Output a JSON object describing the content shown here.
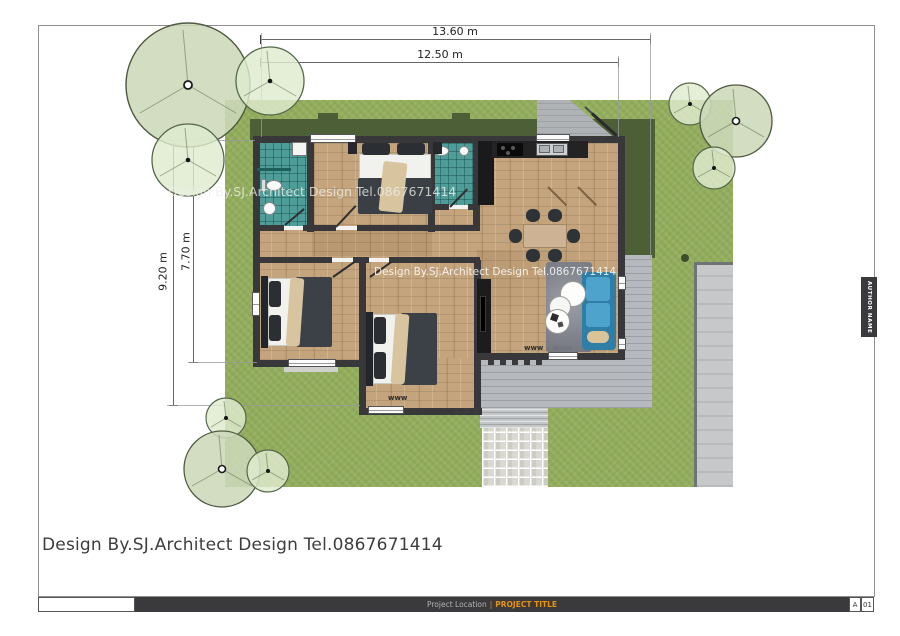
{
  "drawing": {
    "dimensions": {
      "top_outer": "13.60 m",
      "top_inner": "12.50 m",
      "left_outer": "9.20 m",
      "left_inner": "7.70 m"
    },
    "watermarks": {
      "upper": "Design By.SJ.Architect Design Tel.0867671414",
      "lower": "Design By.SJ.Architect Design Tel.0867671414"
    },
    "signature": "Design By.SJ.Architect Design Tel.0867671414",
    "symbols": {
      "folding_door": "www"
    },
    "title_block": {
      "project_location": "Project Location",
      "separator": "|",
      "project_title": "PROJECT TITLE",
      "revision_letter": "A",
      "sheet_number": "01",
      "author_label": "AUTHOR NAME"
    },
    "colors": {
      "grass": "#94ae5e",
      "roof_shadow": "#4d5f37",
      "wall": "#38383a",
      "wood_floor": "#c3a47c",
      "bathroom_tile": "#4f9d99",
      "sofa_blue": "#3f93bd",
      "terrace_gray": "#b6b9bd",
      "title_accent_orange": "#e8920c"
    }
  }
}
